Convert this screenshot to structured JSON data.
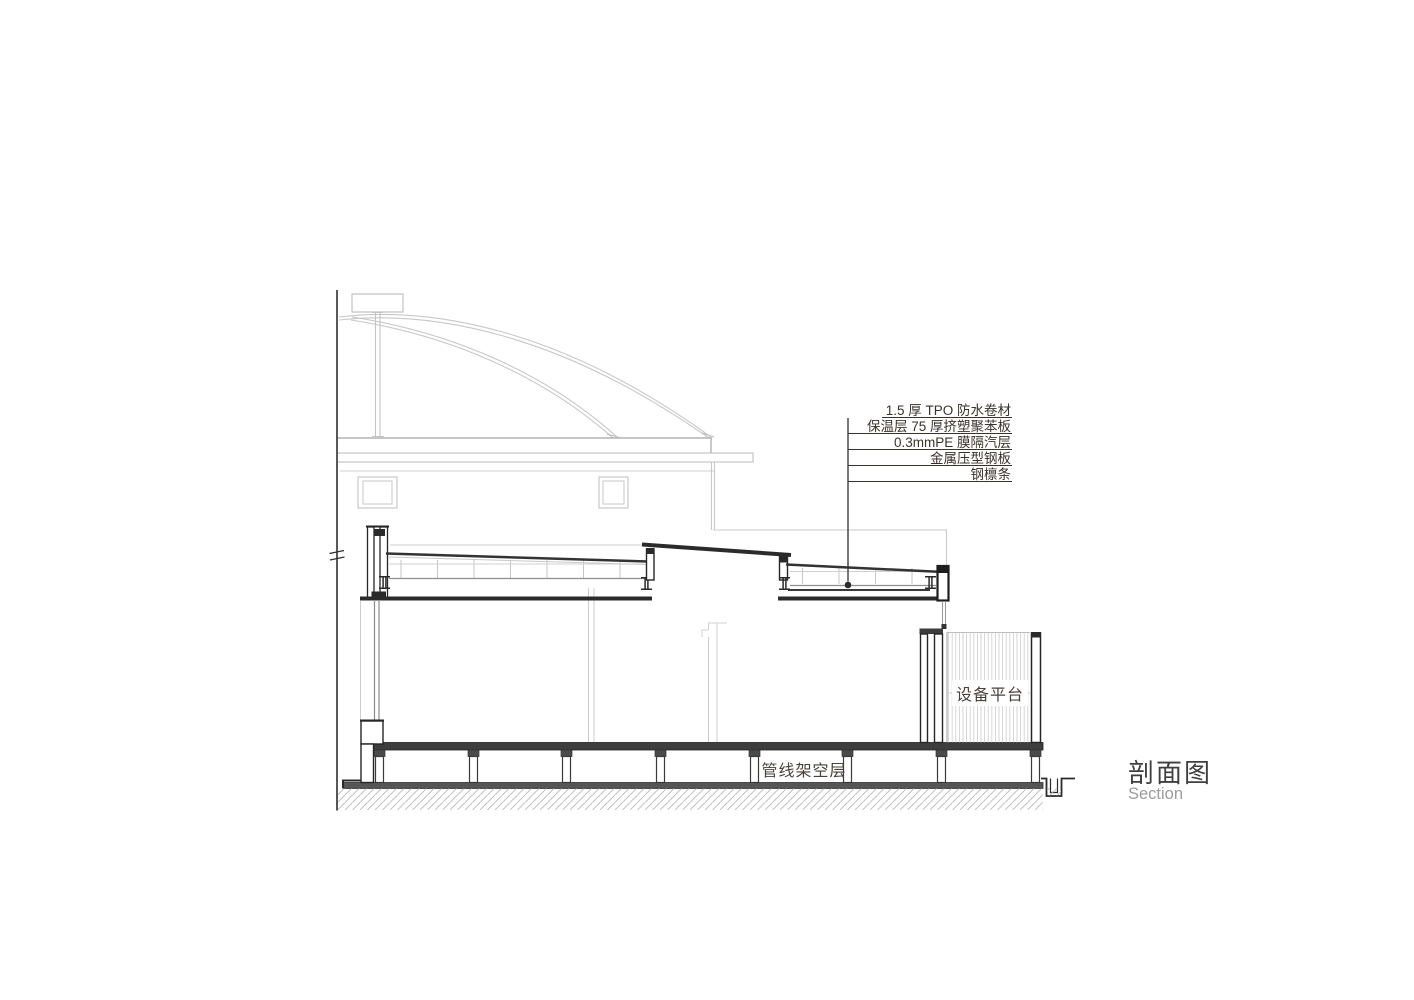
{
  "drawing": {
    "title_cn": "剖面图",
    "title_en": "Section",
    "roof_assembly_labels": [
      "1.5 厚 TPO 防水卷材",
      "保温层 75 厚挤塑聚苯板",
      "0.3mmPE 膜隔汽层",
      "金属压型钢板",
      "钢檩条"
    ],
    "space_labels": {
      "equipment_platform": "设备平台",
      "pipeline_plenum": "管线架空层"
    },
    "colors": {
      "line_dark": "#262626",
      "line_light": "#c8c8c8",
      "slab_fill": "#3e3e3e",
      "text_dark": "#3a332c",
      "text_muted": "#9c9c9c"
    }
  }
}
